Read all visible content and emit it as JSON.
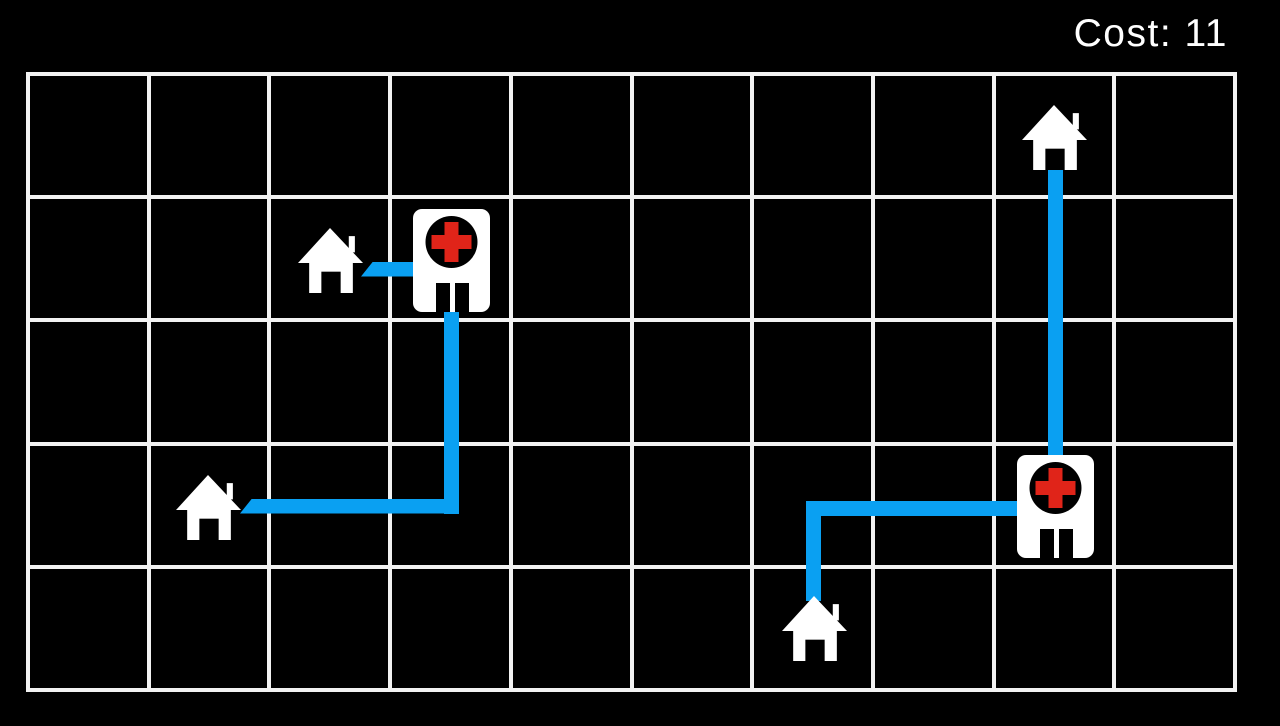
{
  "hud": {
    "cost_label": "Cost: ",
    "cost_value": "11"
  },
  "colors": {
    "background": "#000000",
    "grid_line": "#f2f2f2",
    "road_blue": "#0aa0f2",
    "cross_red": "#e02419",
    "icon_white": "#ffffff",
    "icon_black": "#000000"
  },
  "board": {
    "cols": 10,
    "rows": 5,
    "left": 28,
    "top": 74,
    "width": 1207,
    "height": 616,
    "line_thickness": 4
  },
  "entities": [
    {
      "id": "hospital-a",
      "type": "hospital",
      "col": 3,
      "row": 1,
      "cx": 451,
      "cy": 260
    },
    {
      "id": "hospital-b",
      "type": "hospital",
      "col": 8,
      "row": 3,
      "cx": 1055,
      "cy": 506
    },
    {
      "id": "house-top",
      "type": "house",
      "col": 8,
      "row": 0,
      "cx": 1054,
      "cy": 137
    },
    {
      "id": "house-mid",
      "type": "house",
      "col": 2,
      "row": 1,
      "cx": 330,
      "cy": 260
    },
    {
      "id": "house-left",
      "type": "house",
      "col": 1,
      "row": 3,
      "cx": 208,
      "cy": 507
    },
    {
      "id": "house-bottom",
      "type": "house",
      "col": 6,
      "row": 4,
      "cx": 814,
      "cy": 628
    }
  ],
  "roads": [
    {
      "id": "road-house-mid-to-hospital-a",
      "from": "house-mid",
      "to": "hospital-a",
      "segments": [
        {
          "left": 361,
          "top": 261.5,
          "width": 90,
          "height": 15,
          "bevel": "left"
        }
      ]
    },
    {
      "id": "road-house-left-to-hospital-a",
      "from": "house-left",
      "to": "hospital-a",
      "segments": [
        {
          "left": 443.5,
          "top": 262,
          "width": 15,
          "height": 251.5
        },
        {
          "left": 240,
          "top": 498.5,
          "width": 218.5,
          "height": 15,
          "bevel": "left"
        }
      ]
    },
    {
      "id": "road-house-bottom-to-hospital-b",
      "from": "house-bottom",
      "to": "hospital-b",
      "segments": [
        {
          "left": 805.5,
          "top": 500.5,
          "width": 249.5,
          "height": 15
        },
        {
          "left": 805.5,
          "top": 500.5,
          "width": 15,
          "height": 100.5
        }
      ]
    },
    {
      "id": "road-house-top-to-hospital-b",
      "from": "house-top",
      "to": "hospital-b",
      "segments": [
        {
          "left": 1047.5,
          "top": 137,
          "width": 15,
          "height": 369
        }
      ]
    }
  ],
  "icon_geometry": {
    "house": {
      "width": 65,
      "height": 65
    },
    "hospital": {
      "width": 77,
      "height": 103
    }
  }
}
